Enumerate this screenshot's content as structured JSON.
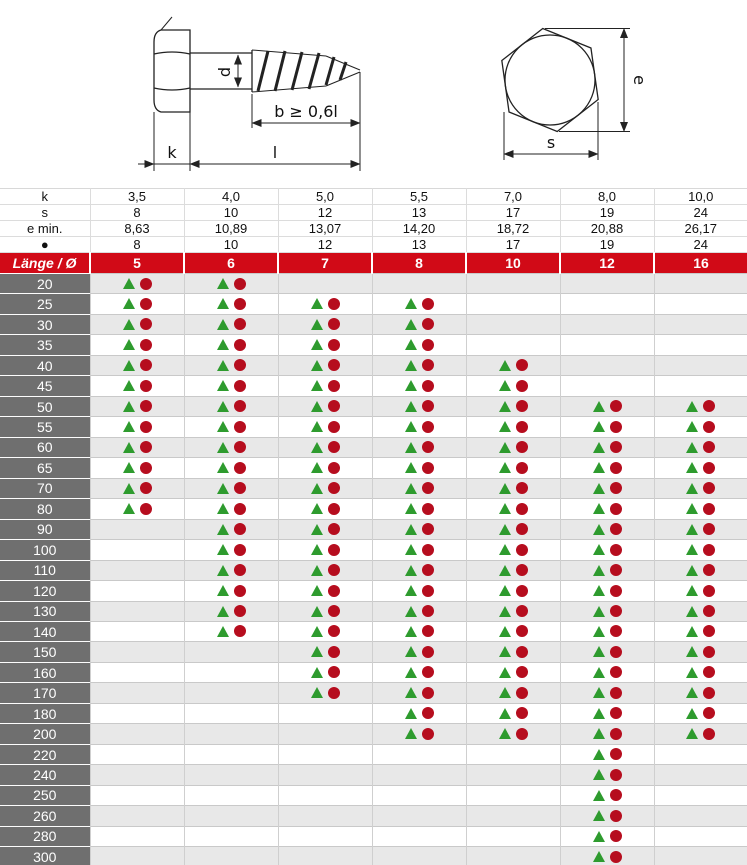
{
  "drawing": {
    "side_view": {
      "d_label": "d",
      "b_label": "b ≥  0,6l",
      "k_label": "k",
      "l_label": "l"
    },
    "top_view": {
      "e_label": "e",
      "s_label": "s"
    }
  },
  "table": {
    "spec_rows": [
      {
        "label": "k",
        "values": [
          "3,5",
          "4,0",
          "5,0",
          "5,5",
          "7,0",
          "8,0",
          "10,0"
        ]
      },
      {
        "label": "s",
        "values": [
          "8",
          "10",
          "12",
          "13",
          "17",
          "19",
          "24"
        ]
      },
      {
        "label": "e min.",
        "values": [
          "8,63",
          "10,89",
          "13,07",
          "14,20",
          "18,72",
          "20,88",
          "26,17"
        ]
      },
      {
        "label": "●",
        "values": [
          "8",
          "10",
          "12",
          "13",
          "17",
          "19",
          "24"
        ]
      }
    ],
    "diameter_header": {
      "label": "Länge / Ø",
      "values": [
        "5",
        "6",
        "7",
        "8",
        "10",
        "12",
        "16"
      ]
    },
    "length_rows": [
      {
        "length": "20",
        "available": [
          1,
          1,
          0,
          0,
          0,
          0,
          0
        ]
      },
      {
        "length": "25",
        "available": [
          1,
          1,
          1,
          1,
          0,
          0,
          0
        ]
      },
      {
        "length": "30",
        "available": [
          1,
          1,
          1,
          1,
          0,
          0,
          0
        ]
      },
      {
        "length": "35",
        "available": [
          1,
          1,
          1,
          1,
          0,
          0,
          0
        ]
      },
      {
        "length": "40",
        "available": [
          1,
          1,
          1,
          1,
          1,
          0,
          0
        ]
      },
      {
        "length": "45",
        "available": [
          1,
          1,
          1,
          1,
          1,
          0,
          0
        ]
      },
      {
        "length": "50",
        "available": [
          1,
          1,
          1,
          1,
          1,
          1,
          1
        ]
      },
      {
        "length": "55",
        "available": [
          1,
          1,
          1,
          1,
          1,
          1,
          1
        ]
      },
      {
        "length": "60",
        "available": [
          1,
          1,
          1,
          1,
          1,
          1,
          1
        ]
      },
      {
        "length": "65",
        "available": [
          1,
          1,
          1,
          1,
          1,
          1,
          1
        ]
      },
      {
        "length": "70",
        "available": [
          1,
          1,
          1,
          1,
          1,
          1,
          1
        ]
      },
      {
        "length": "80",
        "available": [
          1,
          1,
          1,
          1,
          1,
          1,
          1
        ]
      },
      {
        "length": "90",
        "available": [
          0,
          1,
          1,
          1,
          1,
          1,
          1
        ]
      },
      {
        "length": "100",
        "available": [
          0,
          1,
          1,
          1,
          1,
          1,
          1
        ]
      },
      {
        "length": "110",
        "available": [
          0,
          1,
          1,
          1,
          1,
          1,
          1
        ]
      },
      {
        "length": "120",
        "available": [
          0,
          1,
          1,
          1,
          1,
          1,
          1
        ]
      },
      {
        "length": "130",
        "available": [
          0,
          1,
          1,
          1,
          1,
          1,
          1
        ]
      },
      {
        "length": "140",
        "available": [
          0,
          1,
          1,
          1,
          1,
          1,
          1
        ]
      },
      {
        "length": "150",
        "available": [
          0,
          0,
          1,
          1,
          1,
          1,
          1
        ]
      },
      {
        "length": "160",
        "available": [
          0,
          0,
          1,
          1,
          1,
          1,
          1
        ]
      },
      {
        "length": "170",
        "available": [
          0,
          0,
          1,
          1,
          1,
          1,
          1
        ]
      },
      {
        "length": "180",
        "available": [
          0,
          0,
          0,
          1,
          1,
          1,
          1
        ]
      },
      {
        "length": "200",
        "available": [
          0,
          0,
          0,
          1,
          1,
          1,
          1
        ]
      },
      {
        "length": "220",
        "available": [
          0,
          0,
          0,
          0,
          0,
          1,
          0
        ]
      },
      {
        "length": "240",
        "available": [
          0,
          0,
          0,
          0,
          0,
          1,
          0
        ]
      },
      {
        "length": "250",
        "available": [
          0,
          0,
          0,
          0,
          0,
          1,
          0
        ]
      },
      {
        "length": "260",
        "available": [
          0,
          0,
          0,
          0,
          0,
          1,
          0
        ]
      },
      {
        "length": "280",
        "available": [
          0,
          0,
          0,
          0,
          0,
          1,
          0
        ]
      },
      {
        "length": "300",
        "available": [
          0,
          0,
          0,
          0,
          0,
          1,
          0
        ]
      }
    ]
  },
  "colors": {
    "header_red": "#d10a17",
    "row_label_gray": "#6f6f6f",
    "stripe_gray": "#e8e8e8",
    "marker_green": "#2e9b2e",
    "marker_red": "#b60d1e"
  }
}
